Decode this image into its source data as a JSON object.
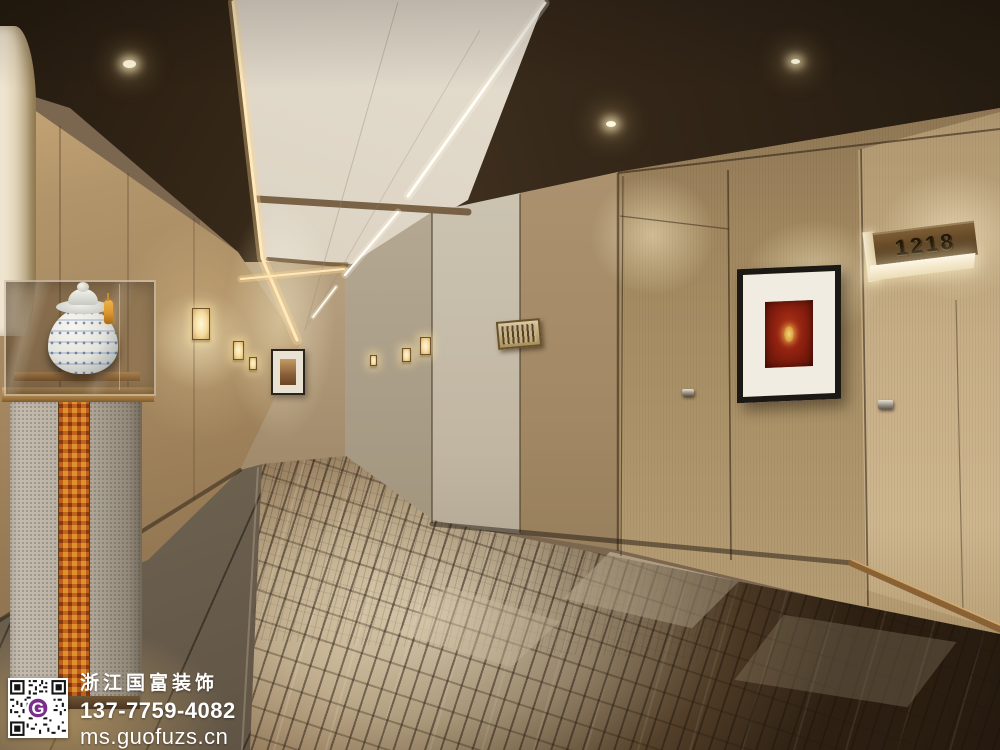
{
  "watermark": {
    "brand": "浙江国富装饰",
    "phone": "137-7759-4082",
    "website": "ms.guofuzs.cn",
    "qr_letter": "G"
  },
  "signage": {
    "room_number": "1218"
  },
  "colors": {
    "ceiling": "#e3dccd",
    "soffit_dark": "#3c2e1f",
    "left_wall_wood": "#a88c62",
    "right_wall_wood": "#a68c64",
    "grey_wall": "#cdc4b4",
    "carpet_light": "#d6c8aa",
    "carpet_dark": "#3b2d1d",
    "tile_grey": "#6e6353",
    "cove_light": "#ffe2a8",
    "artwork_red": "#8e2110",
    "bronze": "#8a6134",
    "qr_purple": "#7b2d8b",
    "porcelain_blue": "#5c74a8",
    "tassel_orange": "#d9962f"
  }
}
